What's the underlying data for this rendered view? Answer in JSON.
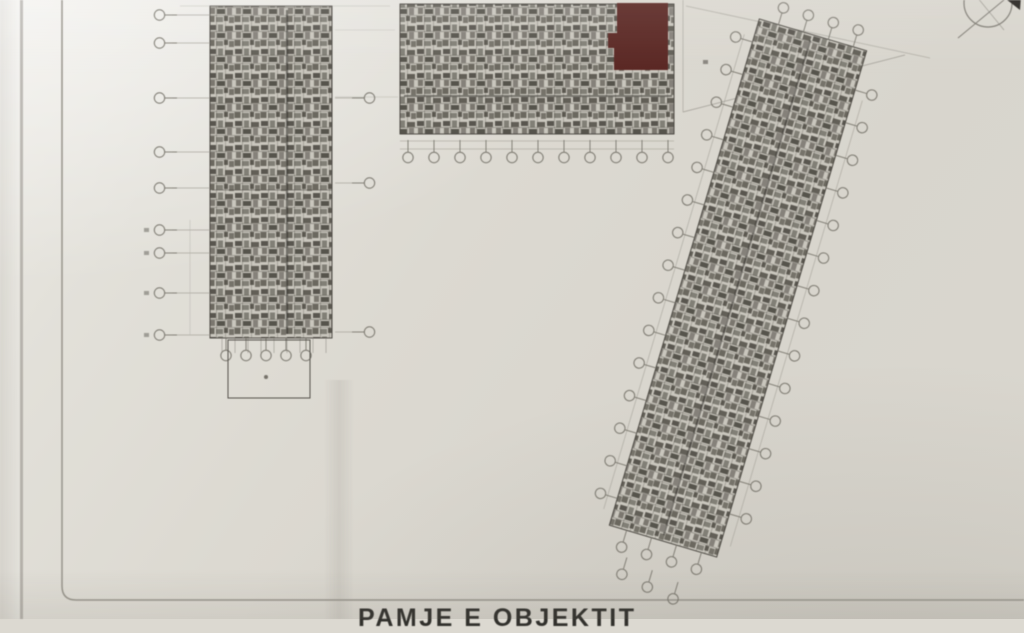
{
  "photo": {
    "caption": "PAMJE E OBJEKTIT"
  },
  "colors": {
    "paper": "#dcd9d1",
    "ink": "#38352f",
    "frame_line": "#97948b",
    "dimension_line": "#a29f96",
    "highlight_unit": "#5a2723"
  },
  "site_plan": {
    "wings": [
      {
        "name": "left-vertical-wing"
      },
      {
        "name": "top-horizontal-wing",
        "highlighted_unit": true
      },
      {
        "name": "right-diagonal-wing",
        "rotation_deg": 16.5
      }
    ]
  },
  "icons": {
    "north_arrow": "north-arrow-icon"
  }
}
